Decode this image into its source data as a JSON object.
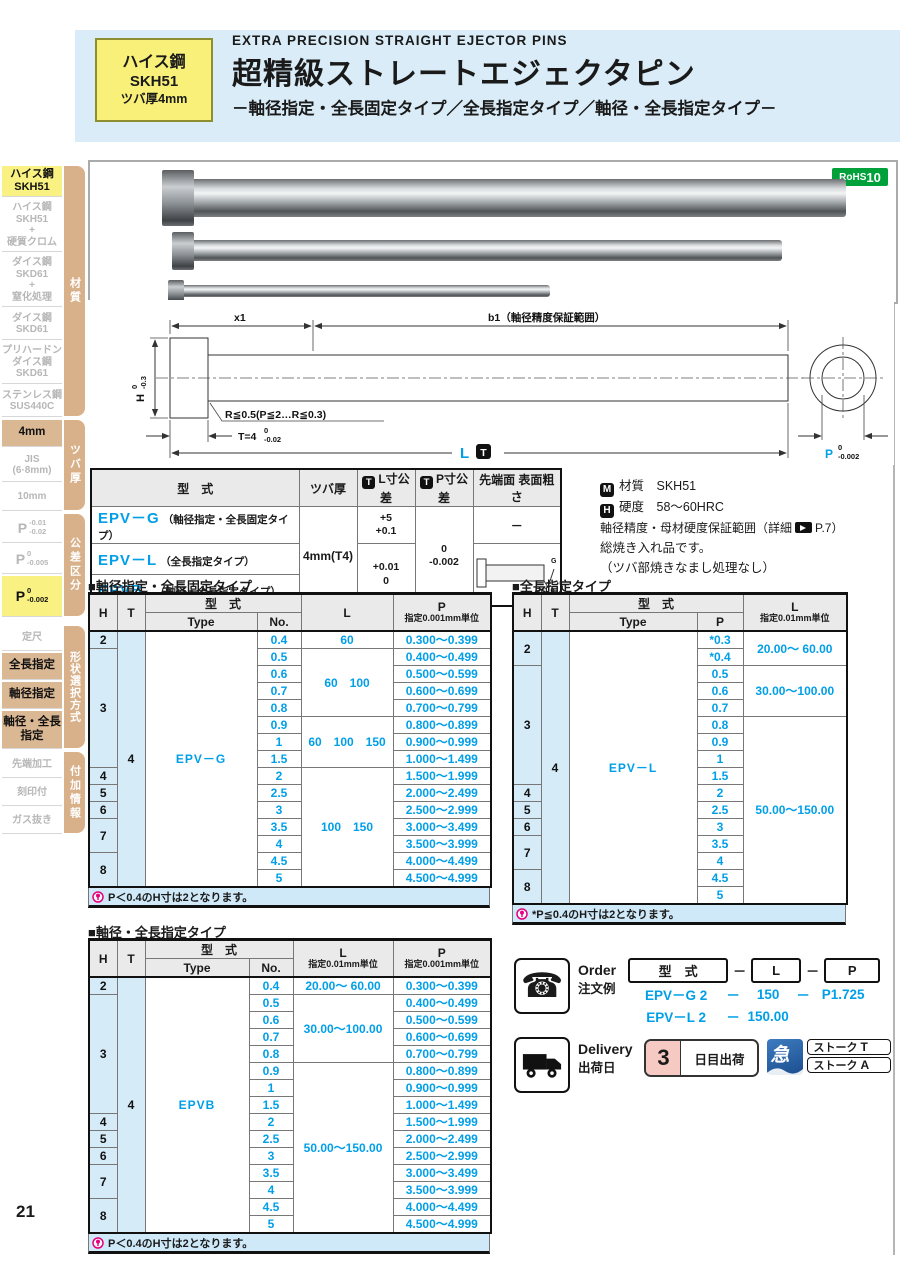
{
  "page": {
    "number": "21"
  },
  "header": {
    "badge": {
      "line1": "ハイス鋼",
      "line2": "SKH51",
      "line3": "ツバ厚4mm"
    },
    "title_en": "EXTRA  PRECISION  STRAIGHT  EJECTOR  PINS",
    "title_ja": "超精級ストレートエジェクタピン",
    "subtitle": "－軸径指定・全長固定タイプ／全長指定タイプ／軸径・全長指定タイプ－"
  },
  "rohs": {
    "label": "RoHS",
    "num": "10"
  },
  "sidebar": {
    "tabs": [
      {
        "label": "材質"
      },
      {
        "label": "ツバ厚"
      },
      {
        "label": "公差区分"
      },
      {
        "label": "形状選択方式"
      },
      {
        "label": "付加情報"
      }
    ],
    "items": [
      {
        "label": "ハイス鋼\nSKH51"
      },
      {
        "label": "ハイス鋼\nSKH51\n+\n硬質クロム"
      },
      {
        "label": "ダイス鋼\nSKD61\n+\n窒化処理"
      },
      {
        "label": "ダイス鋼\nSKD61"
      },
      {
        "label": "プリハードン\nダイス鋼\nSKD61"
      },
      {
        "label": "ステンレス鋼\nSUS440C"
      },
      {
        "label": "4mm"
      },
      {
        "label": "JIS\n(6·8mm)"
      },
      {
        "label": "10mm"
      },
      {
        "p": "P",
        "top": "-0.01",
        "bot": "-0.02"
      },
      {
        "p": "P",
        "top": "0",
        "bot": "-0.005"
      },
      {
        "p": "P",
        "top": "0",
        "bot": "-0.002"
      },
      {
        "label": "定尺"
      },
      {
        "label": "全長指定"
      },
      {
        "label": "軸径指定"
      },
      {
        "label": "軸径・全長\n指定"
      },
      {
        "label": "先端加工"
      },
      {
        "label": "刻印付"
      },
      {
        "label": "ガス抜き"
      }
    ]
  },
  "drawing": {
    "x1": "x1",
    "b1": "b1（軸径精度保証範囲）",
    "h": "H",
    "h_top": "0",
    "h_bot": "-0.3",
    "r_note": "R≦0.5(P≦2…R≦0.3)",
    "t_note": "T=4",
    "t_top": "0",
    "t_bot": "-0.02",
    "l": "L",
    "l_badge": "T",
    "p": "P",
    "p_top": "0",
    "p_bot": "-0.002"
  },
  "spec": {
    "h_model": "型　式",
    "h_collar": "ツバ厚",
    "h_ltol": "L寸公差",
    "h_ptol": "P寸公差",
    "h_tip": "先端面 表面粗さ",
    "badge": "T",
    "rows": [
      {
        "code": "EPV－G",
        "desc": "（軸径指定・全長固定タイプ）"
      },
      {
        "code": "EPV－L",
        "desc": "（全長指定タイプ）"
      },
      {
        "code": "EPVB",
        "desc": "（軸径・全長指定タイプ）"
      }
    ],
    "collar": "4mm(T4)",
    "ltol1_top": "+5",
    "ltol1_bot": "+0.1",
    "ltol2_top": "+0.01",
    "ltol2_bot": "0",
    "ptol_top": "0",
    "ptol_bot": "-0.002",
    "tip1": "－",
    "tip_g": "G",
    "tip_rz": "Rz1.0"
  },
  "notes": {
    "m_badge": "M",
    "m_text": "材質　SKH51",
    "h_badge": "H",
    "h_text": "硬度　58～60HRC",
    "line3a": "軸径精度・母材硬度保証範囲（詳細",
    "line3b": "P.7）",
    "line4": "総焼き入れ品です。",
    "line5": "（ツバ部焼きなまし処理なし）"
  },
  "tables": {
    "t1": {
      "heading": "■軸径指定・全長固定タイプ",
      "head": {
        "h": "H",
        "t": "T",
        "model": "型　式",
        "type": "Type",
        "no": "No.",
        "l": "L",
        "p1": "P",
        "p2": "指定0.001mm単位"
      },
      "rows": [
        [
          {
            "t": "2",
            "c": "h"
          },
          {
            "t": "4",
            "c": "h",
            "rs": 15
          },
          {
            "t": "EPV－G",
            "c": "ty",
            "rs": 15
          },
          {
            "t": "0.4",
            "c": "n"
          },
          {
            "t": "60",
            "c": "v"
          },
          {
            "t": "0.300～0.399",
            "c": "v"
          }
        ],
        [
          {
            "t": "3",
            "c": "h",
            "rs": 7
          },
          {
            "t": "0.5",
            "c": "n"
          },
          {
            "t": "60　100",
            "c": "v",
            "rs": 4
          },
          {
            "t": "0.400～0.499",
            "c": "v"
          }
        ],
        [
          {
            "t": "0.6",
            "c": "n"
          },
          {
            "t": "0.500～0.599",
            "c": "v"
          }
        ],
        [
          {
            "t": "0.7",
            "c": "n"
          },
          {
            "t": "0.600～0.699",
            "c": "v"
          }
        ],
        [
          {
            "t": "0.8",
            "c": "n"
          },
          {
            "t": "0.700～0.799",
            "c": "v"
          }
        ],
        [
          {
            "t": "0.9",
            "c": "n"
          },
          {
            "t": "60　100　150",
            "c": "v",
            "rs": 3
          },
          {
            "t": "0.800～0.899",
            "c": "v"
          }
        ],
        [
          {
            "t": "1",
            "c": "n"
          },
          {
            "t": "0.900～0.999",
            "c": "v"
          }
        ],
        [
          {
            "t": "1.5",
            "c": "n"
          },
          {
            "t": "1.000～1.499",
            "c": "v"
          }
        ],
        [
          {
            "t": "4",
            "c": "h"
          },
          {
            "t": "2",
            "c": "n"
          },
          {
            "t": "100　150",
            "c": "v",
            "rs": 7
          },
          {
            "t": "1.500～1.999",
            "c": "v"
          }
        ],
        [
          {
            "t": "5",
            "c": "h"
          },
          {
            "t": "2.5",
            "c": "n"
          },
          {
            "t": "2.000～2.499",
            "c": "v"
          }
        ],
        [
          {
            "t": "6",
            "c": "h"
          },
          {
            "t": "3",
            "c": "n"
          },
          {
            "t": "2.500～2.999",
            "c": "v"
          }
        ],
        [
          {
            "t": "7",
            "c": "h",
            "rs": 2
          },
          {
            "t": "3.5",
            "c": "n"
          },
          {
            "t": "3.000～3.499",
            "c": "v"
          }
        ],
        [
          {
            "t": "4",
            "c": "n"
          },
          {
            "t": "3.500～3.999",
            "c": "v"
          }
        ],
        [
          {
            "t": "8",
            "c": "h",
            "rs": 2
          },
          {
            "t": "4.5",
            "c": "n"
          },
          {
            "t": "4.000～4.499",
            "c": "v"
          }
        ],
        [
          {
            "t": "5",
            "c": "n"
          },
          {
            "t": "4.500～4.999",
            "c": "v"
          }
        ]
      ],
      "note": "P＜0.4のH寸は2となります。"
    },
    "t2": {
      "heading": "■全長指定タイプ",
      "head": {
        "h": "H",
        "t": "T",
        "model": "型　式",
        "type": "Type",
        "p": "P",
        "l1": "L",
        "l2": "指定0.01mm単位"
      },
      "rows": [
        [
          {
            "t": "2",
            "c": "h",
            "rs": 2
          },
          {
            "t": "4",
            "c": "h",
            "rs": 16
          },
          {
            "t": "EPV－L",
            "c": "ty",
            "rs": 16
          },
          {
            "t": "*0.3",
            "c": "n"
          },
          {
            "t": "20.00～ 60.00",
            "c": "v",
            "rs": 2
          }
        ],
        [
          {
            "t": "*0.4",
            "c": "n"
          }
        ],
        [
          {
            "t": "3",
            "c": "h",
            "rs": 7
          },
          {
            "t": "0.5",
            "c": "n"
          },
          {
            "t": "30.00～100.00",
            "c": "v",
            "rs": 3
          }
        ],
        [
          {
            "t": "0.6",
            "c": "n"
          }
        ],
        [
          {
            "t": "0.7",
            "c": "n"
          }
        ],
        [
          {
            "t": "0.8",
            "c": "n"
          },
          {
            "t": "50.00～150.00",
            "c": "v",
            "rs": 11
          }
        ],
        [
          {
            "t": "0.9",
            "c": "n"
          }
        ],
        [
          {
            "t": "1",
            "c": "n"
          }
        ],
        [
          {
            "t": "1.5",
            "c": "n"
          }
        ],
        [
          {
            "t": "4",
            "c": "h"
          },
          {
            "t": "2",
            "c": "n"
          }
        ],
        [
          {
            "t": "5",
            "c": "h"
          },
          {
            "t": "2.5",
            "c": "n"
          }
        ],
        [
          {
            "t": "6",
            "c": "h"
          },
          {
            "t": "3",
            "c": "n"
          }
        ],
        [
          {
            "t": "7",
            "c": "h",
            "rs": 2
          },
          {
            "t": "3.5",
            "c": "n"
          }
        ],
        [
          {
            "t": "4",
            "c": "n"
          }
        ],
        [
          {
            "t": "8",
            "c": "h",
            "rs": 2
          },
          {
            "t": "4.5",
            "c": "n"
          }
        ],
        [
          {
            "t": "5",
            "c": "n"
          }
        ]
      ],
      "note": "*P≦0.4のH寸は2となります。"
    },
    "t3": {
      "heading": "■軸径・全長指定タイプ",
      "head": {
        "h": "H",
        "t": "T",
        "model": "型　式",
        "type": "Type",
        "no": "No.",
        "l1": "L",
        "l2": "指定0.01mm単位",
        "p1": "P",
        "p2": "指定0.001mm単位"
      },
      "rows": [
        [
          {
            "t": "2",
            "c": "h"
          },
          {
            "t": "4",
            "c": "h",
            "rs": 15
          },
          {
            "t": "EPVB",
            "c": "ty",
            "rs": 15
          },
          {
            "t": "0.4",
            "c": "n"
          },
          {
            "t": "20.00～ 60.00",
            "c": "v"
          },
          {
            "t": "0.300～0.399",
            "c": "v"
          }
        ],
        [
          {
            "t": "3",
            "c": "h",
            "rs": 7
          },
          {
            "t": "0.5",
            "c": "n"
          },
          {
            "t": "30.00～100.00",
            "c": "v",
            "rs": 4
          },
          {
            "t": "0.400～0.499",
            "c": "v"
          }
        ],
        [
          {
            "t": "0.6",
            "c": "n"
          },
          {
            "t": "0.500～0.599",
            "c": "v"
          }
        ],
        [
          {
            "t": "0.7",
            "c": "n"
          },
          {
            "t": "0.600～0.699",
            "c": "v"
          }
        ],
        [
          {
            "t": "0.8",
            "c": "n"
          },
          {
            "t": "0.700～0.799",
            "c": "v"
          }
        ],
        [
          {
            "t": "0.9",
            "c": "n"
          },
          {
            "t": "50.00～150.00",
            "c": "v",
            "rs": 10
          },
          {
            "t": "0.800～0.899",
            "c": "v"
          }
        ],
        [
          {
            "t": "1",
            "c": "n"
          },
          {
            "t": "0.900～0.999",
            "c": "v"
          }
        ],
        [
          {
            "t": "1.5",
            "c": "n"
          },
          {
            "t": "1.000～1.499",
            "c": "v"
          }
        ],
        [
          {
            "t": "4",
            "c": "h"
          },
          {
            "t": "2",
            "c": "n"
          },
          {
            "t": "1.500～1.999",
            "c": "v"
          }
        ],
        [
          {
            "t": "5",
            "c": "h"
          },
          {
            "t": "2.5",
            "c": "n"
          },
          {
            "t": "2.000～2.499",
            "c": "v"
          }
        ],
        [
          {
            "t": "6",
            "c": "h"
          },
          {
            "t": "3",
            "c": "n"
          },
          {
            "t": "2.500～2.999",
            "c": "v"
          }
        ],
        [
          {
            "t": "7",
            "c": "h",
            "rs": 2
          },
          {
            "t": "3.5",
            "c": "n"
          },
          {
            "t": "3.000～3.499",
            "c": "v"
          }
        ],
        [
          {
            "t": "4",
            "c": "n"
          },
          {
            "t": "3.500～3.999",
            "c": "v"
          }
        ],
        [
          {
            "t": "8",
            "c": "h",
            "rs": 2
          },
          {
            "t": "4.5",
            "c": "n"
          },
          {
            "t": "4.000～4.499",
            "c": "v"
          }
        ],
        [
          {
            "t": "5",
            "c": "n"
          },
          {
            "t": "4.500～4.999",
            "c": "v"
          }
        ]
      ],
      "note": "P＜0.4のH寸は2となります。"
    }
  },
  "order": {
    "phone_glyph": "☎",
    "label_en": "Order",
    "label_ja": "注文例",
    "box_model": "型　式",
    "box_l": "L",
    "box_p": "P",
    "dash": "－",
    "ex1": {
      "model": "EPV－G 2",
      "d1": "－",
      "l": "150",
      "d2": "－",
      "p": "P1.725"
    },
    "ex2": {
      "model": "EPV－L 2",
      "d1": "－",
      "l": "150.00"
    }
  },
  "delivery": {
    "label_en": "Delivery",
    "label_ja": "出荷日",
    "days": "3",
    "days_suffix": "日目出荷",
    "express": "急",
    "stork1": "ストーク",
    "stork1_code": "T",
    "stork2": "ストーク",
    "stork2_code": "A"
  }
}
